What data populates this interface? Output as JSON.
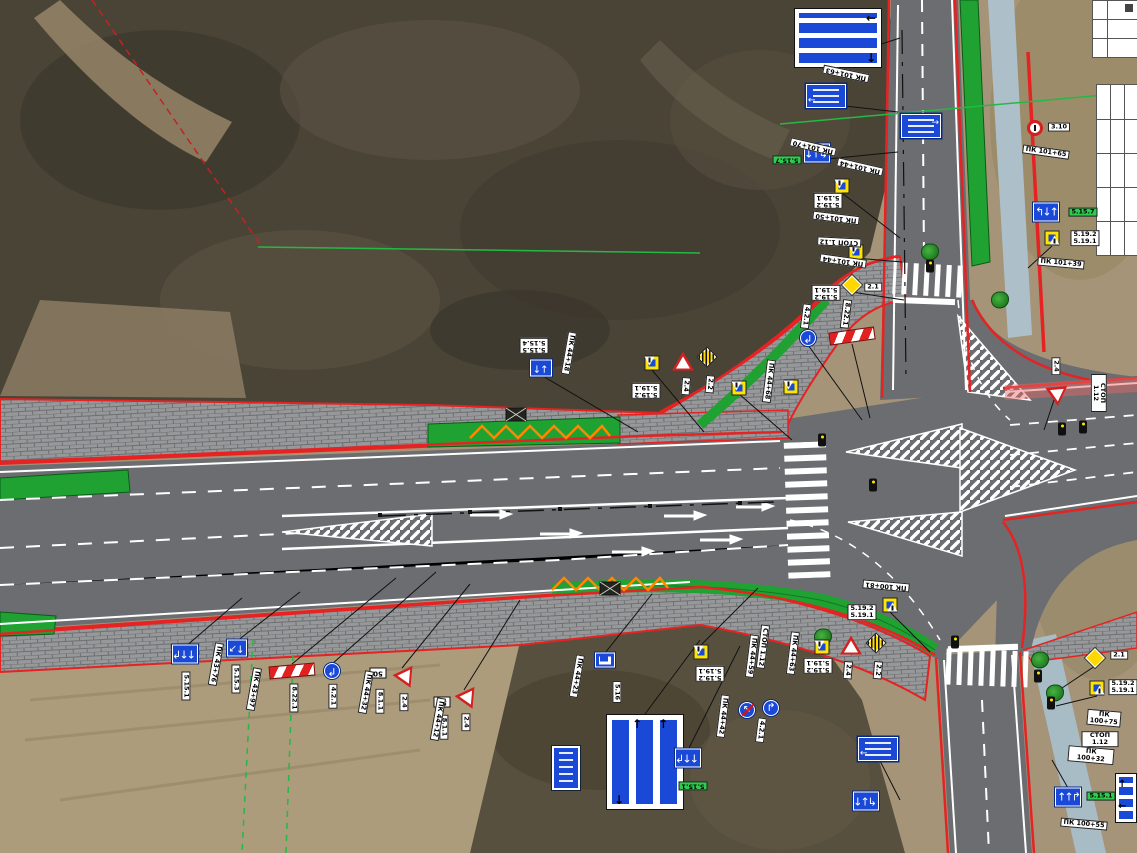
{
  "drawing": {
    "type": "traffic-management-plan-over-aerial-photo",
    "language": "ru",
    "stop_marking_text": "СТОП"
  },
  "colors": {
    "asphalt": "#6b6d70",
    "sidewalk_brick": "#97989a",
    "green_verge": "#1fa232",
    "edge_line_red": "#e62222",
    "canal_blue": "#adc0c9",
    "sign_blue": "#1a49d8",
    "sign_yellow_backing": "#ffe400",
    "priority_yellow": "#ffd800",
    "survey_green": "#25b845",
    "zigzag_orange": "#ff8800"
  },
  "sign_type_legend": {
    "ped": "pedestrian-crossing-sign-5.19",
    "lane-151": "lane-directions-sign-5.15.1",
    "lane-153": "lane-begin-sign-5.15.3",
    "lane-155": "lane-end-sign-5.15.5",
    "lane-157": "lane-directions-sign-5.15.7",
    "bus": "bus-stop-sign-5.16",
    "giveway": "give-way-sign-2.4",
    "mainroad": "priority-road-sign-2.1",
    "endmain": "end-of-priority-road-sign-2.2",
    "barrier": "obstacle-board-8.22.1",
    "round-arrow": "pass-this-side-sign-4.2.1",
    "round-slash": "mandatory-direction-end-sign",
    "no-ped": "no-pedestrians-sign-3.10",
    "plate50": "distance-plate-8.1.1-50",
    "board-big4": "route-information-board",
    "board-big3": "advance-direction-board",
    "board-small": "direction-information-board",
    "board-small2": "information-board",
    "board-dir": "direction-board-partial"
  },
  "board_top": {
    "panel_count": 4,
    "arrow_icons": [
      "arrow-left-icon",
      "arrow-down-icon"
    ]
  },
  "board_bottom": {
    "panel_count": 3,
    "arrow_icons": [
      "arrow-up-icon",
      "arrow-up-icon",
      "arrow-down-icon"
    ]
  },
  "signs": [
    {
      "t": "board-big4",
      "x": 838,
      "y": 38,
      "r": 0
    },
    {
      "t": "board-small",
      "x": 826,
      "y": 96,
      "r": 180
    },
    {
      "t": "lane-157",
      "x": 817,
      "y": 153,
      "r": 180
    },
    {
      "t": "ped",
      "x": 842,
      "y": 186,
      "r": 180
    },
    {
      "t": "ped",
      "x": 856,
      "y": 252,
      "r": 180
    },
    {
      "t": "mainroad",
      "x": 852,
      "y": 285,
      "r": 0
    },
    {
      "t": "round-arrow",
      "x": 808,
      "y": 338,
      "r": 180
    },
    {
      "t": "barrier",
      "x": 852,
      "y": 336,
      "r": -8
    },
    {
      "t": "lane-155",
      "x": 541,
      "y": 368,
      "r": 180
    },
    {
      "t": "ped",
      "x": 652,
      "y": 363,
      "r": 180
    },
    {
      "t": "giveway",
      "x": 683,
      "y": 361,
      "r": 180
    },
    {
      "t": "endmain",
      "x": 707,
      "y": 357,
      "r": 180
    },
    {
      "t": "ped",
      "x": 739,
      "y": 388,
      "r": 180
    },
    {
      "t": "ped",
      "x": 791,
      "y": 387,
      "r": 180
    },
    {
      "t": "no-ped",
      "x": 1035,
      "y": 128,
      "r": 0
    },
    {
      "t": "board-small",
      "x": 921,
      "y": 126,
      "r": 0
    },
    {
      "t": "lane-157",
      "x": 1046,
      "y": 212,
      "r": 0
    },
    {
      "t": "ped",
      "x": 1052,
      "y": 238,
      "r": 0
    },
    {
      "t": "giveway",
      "x": 1054,
      "y": 392,
      "r": 115
    },
    {
      "t": "lane-151",
      "x": 185,
      "y": 654,
      "r": 180
    },
    {
      "t": "lane-153",
      "x": 237,
      "y": 648,
      "r": 180
    },
    {
      "t": "barrier",
      "x": 292,
      "y": 671,
      "r": -5
    },
    {
      "t": "round-arrow",
      "x": 332,
      "y": 671,
      "r": 180
    },
    {
      "t": "plate50",
      "x": 378,
      "y": 673,
      "r": 180,
      "txt": "50"
    },
    {
      "t": "giveway",
      "x": 402,
      "y": 676,
      "r": 95
    },
    {
      "t": "plate50",
      "x": 442,
      "y": 702,
      "r": 180,
      "txt": "50"
    },
    {
      "t": "giveway",
      "x": 464,
      "y": 697,
      "r": 95
    },
    {
      "t": "bus",
      "x": 605,
      "y": 660,
      "r": 180
    },
    {
      "t": "ped",
      "x": 701,
      "y": 652,
      "r": 180
    },
    {
      "t": "round-slash",
      "x": 747,
      "y": 710,
      "r": 0
    },
    {
      "t": "round-arrow",
      "x": 771,
      "y": 708,
      "r": 0
    },
    {
      "t": "board-big3",
      "x": 645,
      "y": 762,
      "r": 0
    },
    {
      "t": "board-small2",
      "x": 566,
      "y": 768,
      "r": 180
    },
    {
      "t": "lane-151",
      "x": 688,
      "y": 758,
      "r": 180
    },
    {
      "t": "ped",
      "x": 890,
      "y": 605,
      "r": 0
    },
    {
      "t": "ped",
      "x": 822,
      "y": 647,
      "r": 180
    },
    {
      "t": "giveway",
      "x": 851,
      "y": 645,
      "r": 180
    },
    {
      "t": "endmain",
      "x": 876,
      "y": 643,
      "r": 180
    },
    {
      "t": "board-small",
      "x": 878,
      "y": 749,
      "r": 180
    },
    {
      "t": "lane-157",
      "x": 866,
      "y": 801,
      "r": 180
    },
    {
      "t": "mainroad",
      "x": 1095,
      "y": 658,
      "r": 0
    },
    {
      "t": "ped",
      "x": 1097,
      "y": 688,
      "r": 0
    },
    {
      "t": "lane-151",
      "x": 1068,
      "y": 797,
      "r": 0
    },
    {
      "t": "board-dir",
      "x": 1126,
      "y": 798,
      "r": 0
    }
  ],
  "labels": [
    {
      "text": "ПК 101+63",
      "x": 846,
      "y": 74,
      "r": 192
    },
    {
      "text": "ПК 101+70",
      "x": 813,
      "y": 147,
      "r": 193
    },
    {
      "text": "5.15.7",
      "x": 787,
      "y": 160,
      "r": 180,
      "style": "green"
    },
    {
      "text": "5.19.2\n5.19.1",
      "x": 828,
      "y": 201,
      "r": 180
    },
    {
      "text": "ПК 101+44",
      "x": 860,
      "y": 167,
      "r": 193
    },
    {
      "text": "ПК 101+50",
      "x": 836,
      "y": 218,
      "r": 187
    },
    {
      "text": "СТОП 1.12",
      "x": 839,
      "y": 242,
      "r": 183
    },
    {
      "text": "ПК 101+44",
      "x": 843,
      "y": 261,
      "r": 188
    },
    {
      "text": "5.19.2\n5.19.1",
      "x": 826,
      "y": 293,
      "r": 180
    },
    {
      "text": "2.1",
      "x": 873,
      "y": 287,
      "r": 0
    },
    {
      "text": "4.2.1",
      "x": 806,
      "y": 316,
      "r": 97
    },
    {
      "text": "8.22.1",
      "x": 846,
      "y": 314,
      "r": 97
    },
    {
      "text": "3.10",
      "x": 1059,
      "y": 127,
      "r": 0
    },
    {
      "text": "ПК 101+65",
      "x": 1046,
      "y": 152,
      "r": 8
    },
    {
      "text": "5.15.7",
      "x": 1083,
      "y": 212,
      "r": 0,
      "style": "green"
    },
    {
      "text": "5.19.2\n5.19.1",
      "x": 1085,
      "y": 238,
      "r": 0
    },
    {
      "text": "ПК 101+39",
      "x": 1061,
      "y": 263,
      "r": 5
    },
    {
      "text": "2.4",
      "x": 1056,
      "y": 366,
      "r": 90
    },
    {
      "text": "СТОП 1.12",
      "x": 1099,
      "y": 393,
      "r": 90
    },
    {
      "text": "5.15.5\n5.15.4",
      "x": 534,
      "y": 346,
      "r": 180
    },
    {
      "text": "ПК 44+18",
      "x": 569,
      "y": 353,
      "r": 100
    },
    {
      "text": "5.19.2\n5.19.1",
      "x": 646,
      "y": 391,
      "r": 180
    },
    {
      "text": "2.4",
      "x": 686,
      "y": 386,
      "r": 95
    },
    {
      "text": "2.2",
      "x": 710,
      "y": 384,
      "r": 95
    },
    {
      "text": "ПК 44+68",
      "x": 769,
      "y": 381,
      "r": 97
    },
    {
      "text": "5.19.2\n5.19.1",
      "x": 710,
      "y": 674,
      "r": 180
    },
    {
      "text": "ПК 44+59",
      "x": 752,
      "y": 656,
      "r": 97
    },
    {
      "text": "СТОП 1.12",
      "x": 763,
      "y": 647,
      "r": 97
    },
    {
      "text": "ПК 44+63",
      "x": 793,
      "y": 653,
      "r": 97
    },
    {
      "text": "ПК 44+42",
      "x": 723,
      "y": 716,
      "r": 97
    },
    {
      "text": "4.2.1",
      "x": 761,
      "y": 730,
      "r": 97
    },
    {
      "text": "5.15.1",
      "x": 186,
      "y": 686,
      "r": 90
    },
    {
      "text": "ПК 43+76",
      "x": 216,
      "y": 664,
      "r": 100
    },
    {
      "text": "5.15.3",
      "x": 236,
      "y": 679,
      "r": 90
    },
    {
      "text": "ПК 43+97",
      "x": 254,
      "y": 689,
      "r": 100
    },
    {
      "text": "8.22.1",
      "x": 294,
      "y": 698,
      "r": 90
    },
    {
      "text": "4.2.1",
      "x": 333,
      "y": 696,
      "r": 90
    },
    {
      "text": "ПК 44+32",
      "x": 366,
      "y": 692,
      "r": 100
    },
    {
      "text": "8.1.1",
      "x": 380,
      "y": 701,
      "r": 90
    },
    {
      "text": "2.4",
      "x": 404,
      "y": 702,
      "r": 90
    },
    {
      "text": "8.1.1",
      "x": 444,
      "y": 727,
      "r": 90
    },
    {
      "text": "2.4",
      "x": 466,
      "y": 722,
      "r": 90
    },
    {
      "text": "ПК 44+12",
      "x": 438,
      "y": 719,
      "r": 100
    },
    {
      "text": "ПК 44+23",
      "x": 577,
      "y": 676,
      "r": 100
    },
    {
      "text": "5.16",
      "x": 617,
      "y": 692,
      "r": 90
    },
    {
      "text": "5.19.2\n5.19.1",
      "x": 862,
      "y": 612,
      "r": 0
    },
    {
      "text": "ПК 100+81",
      "x": 886,
      "y": 586,
      "r": 185
    },
    {
      "text": "5.19.2\n5.19.1",
      "x": 818,
      "y": 666,
      "r": 180
    },
    {
      "text": "2.4",
      "x": 848,
      "y": 670,
      "r": 95
    },
    {
      "text": "2.2",
      "x": 878,
      "y": 670,
      "r": 95
    },
    {
      "text": "2.1",
      "x": 1119,
      "y": 655,
      "r": 0
    },
    {
      "text": "5.19.2\n5.19.1",
      "x": 1123,
      "y": 687,
      "r": 0
    },
    {
      "text": "ПК 100+75",
      "x": 1104,
      "y": 718,
      "r": 5
    },
    {
      "text": "СТОП 1.12",
      "x": 1100,
      "y": 739,
      "r": 0
    },
    {
      "text": "ПК 100+32",
      "x": 1091,
      "y": 755,
      "r": 5
    },
    {
      "text": "5.15.1",
      "x": 1101,
      "y": 796,
      "r": 0,
      "style": "green"
    },
    {
      "text": "ПК 100+55",
      "x": 1084,
      "y": 824,
      "r": 5
    },
    {
      "text": "5.15.1",
      "x": 693,
      "y": 786,
      "r": 180,
      "style": "green"
    }
  ],
  "signals": [
    {
      "x": 1062,
      "y": 429
    },
    {
      "x": 1083,
      "y": 427
    },
    {
      "x": 1038,
      "y": 676
    },
    {
      "x": 1051,
      "y": 703
    },
    {
      "x": 822,
      "y": 440
    },
    {
      "x": 930,
      "y": 266
    },
    {
      "x": 873,
      "y": 485
    },
    {
      "x": 955,
      "y": 642
    }
  ],
  "trees": [
    {
      "x": 1040,
      "y": 660
    },
    {
      "x": 1055,
      "y": 693
    },
    {
      "x": 1000,
      "y": 300
    },
    {
      "x": 930,
      "y": 252
    },
    {
      "x": 823,
      "y": 637
    }
  ]
}
